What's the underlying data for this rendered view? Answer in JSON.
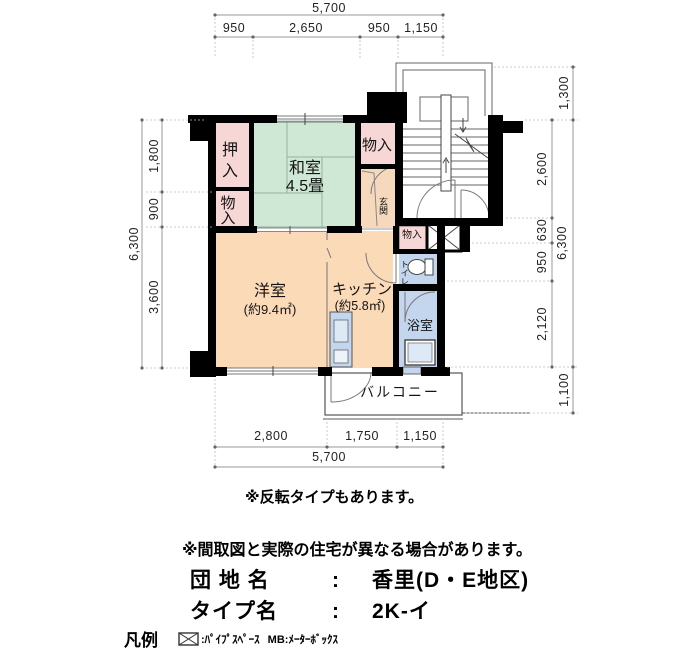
{
  "plan": {
    "rooms": {
      "oshiire": "押入",
      "monoire_left": "物入",
      "washitsu_name": "和室",
      "washitsu_size": "4.5畳",
      "monoire_top": "物入",
      "genkan": "玄関",
      "yoshitsu_name": "洋室",
      "yoshitsu_size": "(約9.4㎡)",
      "kitchen_name": "キッチン",
      "kitchen_size": "(約5.8㎡)",
      "monoire_small": "物入",
      "toilet": "トイレ",
      "bath": "浴室",
      "balcony": "バルコニー"
    },
    "dims": {
      "top_total": "5,700",
      "top": [
        "950",
        "2,650",
        "950",
        "1,150"
      ],
      "left_total": "6,300",
      "left": [
        "1,800",
        "900",
        "3,600"
      ],
      "right_inner": [
        "2,600",
        "630",
        "950",
        "2,120"
      ],
      "right_outer": [
        "1,300",
        "6,300",
        "1,100"
      ],
      "bottom": [
        "2,800",
        "1,750",
        "1,150"
      ],
      "bottom_total": "5,700"
    },
    "colors": {
      "wall": "#000000",
      "tatami_green": "#cfe8d5",
      "closet_pink": "#f7d7d6",
      "room_peach": "#fbdab8",
      "genkan_tan": "#f6d9bd",
      "wet_blue": "#c3d6ee",
      "sink_blue": "#dde9f6",
      "dim_line": "#999999"
    }
  },
  "notes": {
    "note1": "※反転タイプもあります。",
    "note2": "※間取図と実際の住宅が異なる場合があります。"
  },
  "info": {
    "danchi_label": "団 地 名",
    "danchi_sep": ":",
    "danchi_value": "香里(D・E地区)",
    "type_label": "タイプ名",
    "type_sep": ":",
    "type_value": "2K-イ"
  },
  "legend": {
    "title": "凡例",
    "ps_icon": "pipe-space-box",
    "ps_text": ":ﾊﾟｲﾌﾟｽﾍﾟｰｽ",
    "mb_text": "MB:ﾒｰﾀｰﾎﾞｯｸｽ"
  }
}
